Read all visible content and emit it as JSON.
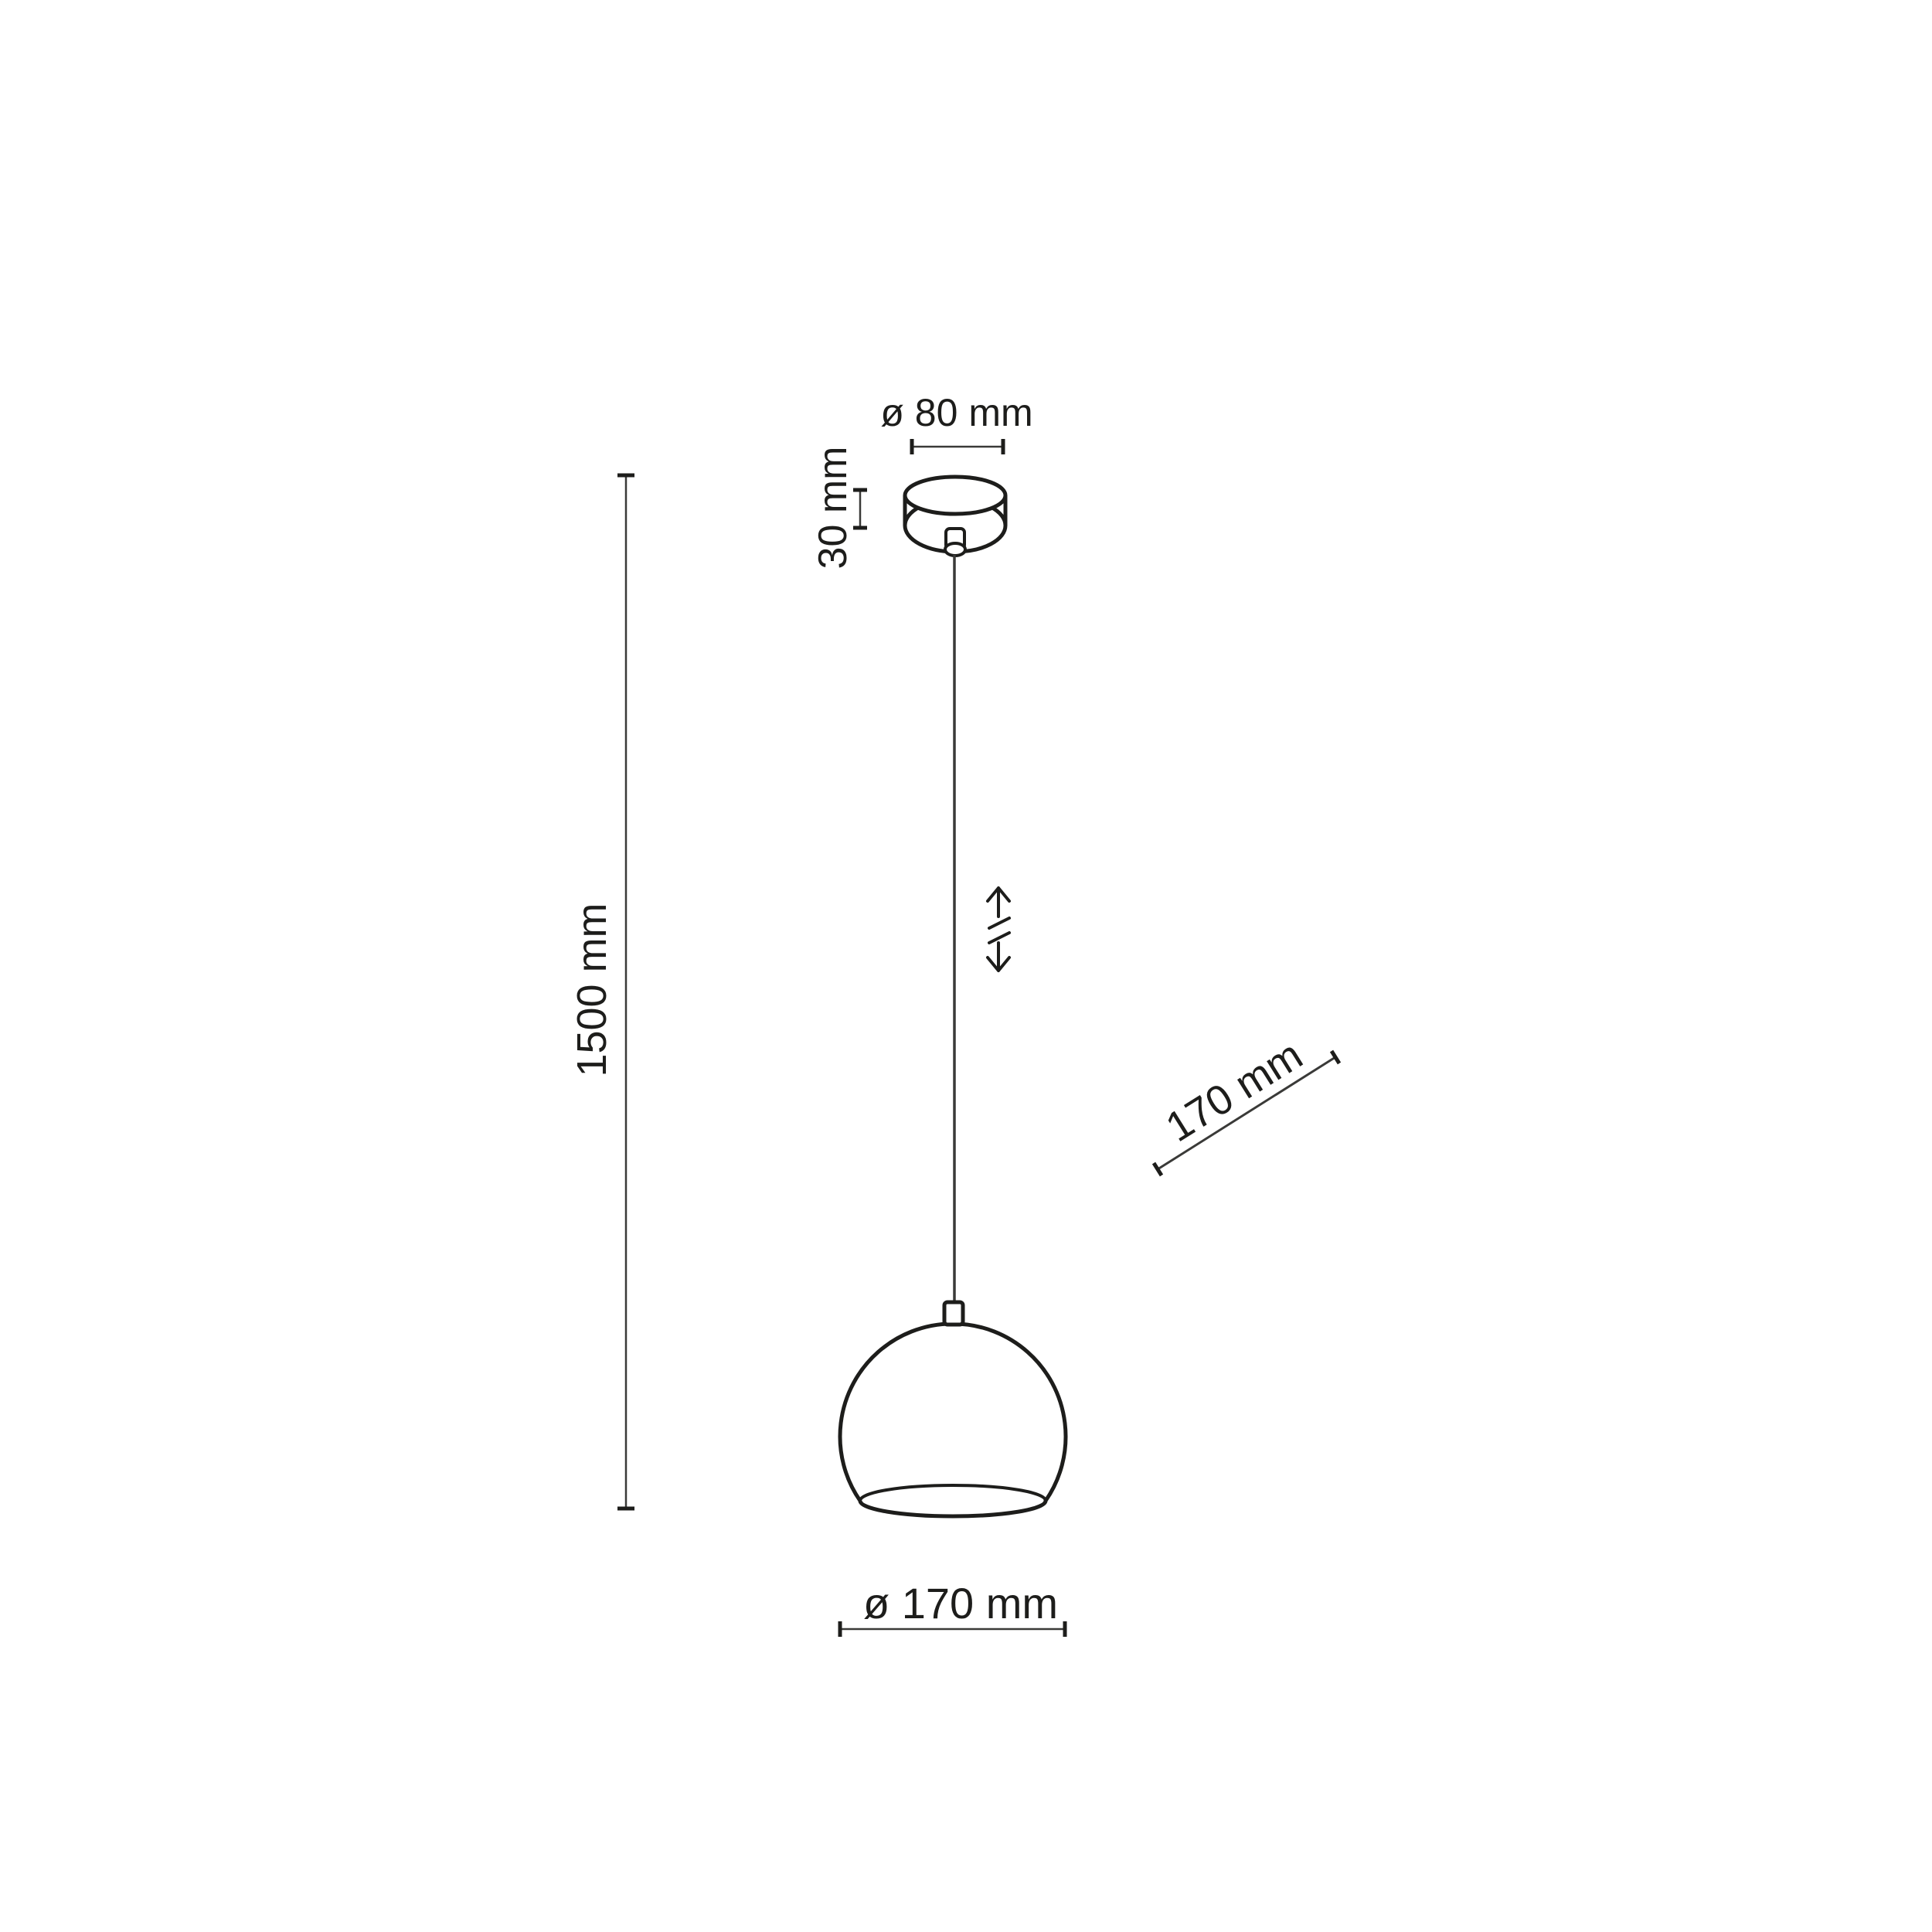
{
  "diagram": {
    "title": "pendant-lamp-dimension-drawing",
    "labels": {
      "canopy_diameter": "ø 80 mm",
      "canopy_height": "30 mm",
      "suspension_length": "1500 mm",
      "shade_height": "170 mm",
      "shade_diameter": "ø 170 mm"
    },
    "icons": {
      "height_adjustable": "double-vertical-arrow-with-break"
    },
    "colors": {
      "line": "#1d1d1b",
      "dim": "#3a3a38",
      "background": "#ffffff"
    }
  }
}
